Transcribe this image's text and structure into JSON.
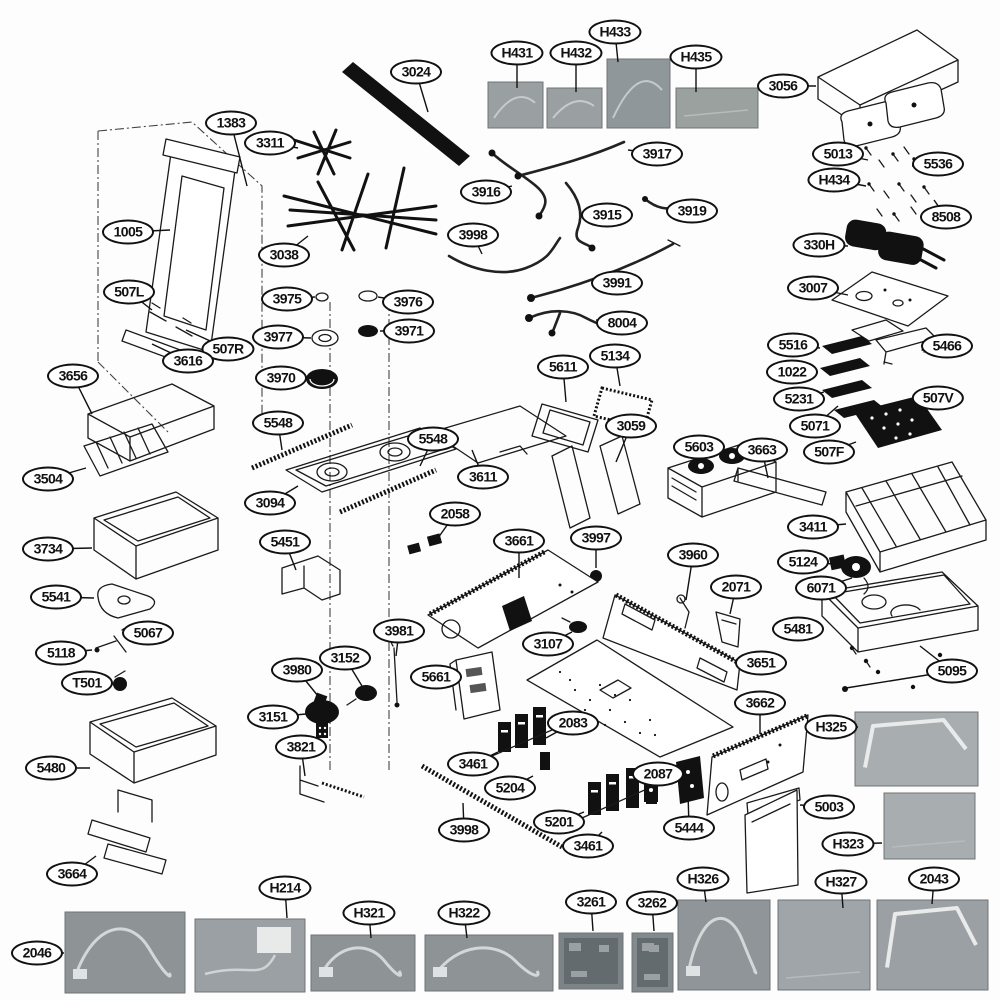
{
  "diagram": {
    "type": "exploded-parts-diagram",
    "background": "#fdfdfd"
  },
  "colors": {
    "line": "#1a1a1a",
    "callout_border": "#111111",
    "photo_gray": "#9aa0a3"
  },
  "callouts": [
    {
      "label": "1383",
      "x": 231,
      "y": 123,
      "to": [
        [
          247,
          186
        ]
      ]
    },
    {
      "label": "3311",
      "x": 270,
      "y": 143,
      "to": [
        [
          298,
          148
        ]
      ]
    },
    {
      "label": "3024",
      "x": 416,
      "y": 72,
      "to": [
        [
          428,
          112
        ]
      ]
    },
    {
      "label": "H431",
      "x": 517,
      "y": 53,
      "to": [
        [
          517,
          88
        ]
      ]
    },
    {
      "label": "H432",
      "x": 576,
      "y": 53,
      "to": [
        [
          576,
          92
        ]
      ]
    },
    {
      "label": "H433",
      "x": 615,
      "y": 32,
      "to": [
        [
          618,
          62
        ]
      ]
    },
    {
      "label": "H435",
      "x": 696,
      "y": 57,
      "to": [
        [
          696,
          92
        ]
      ]
    },
    {
      "label": "3056",
      "x": 783,
      "y": 86,
      "to": [
        [
          816,
          86
        ]
      ]
    },
    {
      "label": "5013",
      "x": 838,
      "y": 154,
      "to": [
        [
          868,
          160
        ]
      ]
    },
    {
      "label": "5536",
      "x": 938,
      "y": 164,
      "to": [
        [
          912,
          166
        ]
      ]
    },
    {
      "label": "H434",
      "x": 834,
      "y": 180,
      "to": [
        [
          866,
          186
        ]
      ]
    },
    {
      "label": "8508",
      "x": 946,
      "y": 217,
      "to": [
        [
          934,
          200
        ]
      ]
    },
    {
      "label": "3919",
      "x": 692,
      "y": 211,
      "to": [
        [
          673,
          208
        ]
      ]
    },
    {
      "label": "3917",
      "x": 657,
      "y": 154,
      "to": [
        [
          628,
          150
        ]
      ]
    },
    {
      "label": "3916",
      "x": 486,
      "y": 192,
      "to": [
        [
          512,
          186
        ]
      ]
    },
    {
      "label": "3915",
      "x": 607,
      "y": 215,
      "to": [
        [
          584,
          220
        ]
      ]
    },
    {
      "label": "3998",
      "x": 473,
      "y": 235,
      "to": [
        [
          482,
          254
        ]
      ]
    },
    {
      "label": "1005",
      "x": 128,
      "y": 232,
      "to": [
        [
          170,
          230
        ]
      ]
    },
    {
      "label": "3038",
      "x": 284,
      "y": 255,
      "to": [
        [
          308,
          236
        ]
      ]
    },
    {
      "label": "330H",
      "x": 819,
      "y": 245,
      "to": [
        [
          848,
          246
        ]
      ]
    },
    {
      "label": "3007",
      "x": 813,
      "y": 288,
      "to": [
        [
          848,
          295
        ]
      ]
    },
    {
      "label": "507L",
      "x": 129,
      "y": 292,
      "to": [
        [
          152,
          310
        ]
      ]
    },
    {
      "label": "3975",
      "x": 287,
      "y": 299,
      "to": [
        [
          315,
          297
        ]
      ]
    },
    {
      "label": "3976",
      "x": 408,
      "y": 302,
      "to": [
        [
          378,
          297
        ]
      ]
    },
    {
      "label": "3971",
      "x": 409,
      "y": 331,
      "to": [
        [
          380,
          331
        ]
      ]
    },
    {
      "label": "3977",
      "x": 278,
      "y": 337,
      "to": [
        [
          311,
          338
        ]
      ]
    },
    {
      "label": "507R",
      "x": 228,
      "y": 349,
      "to": [
        [
          186,
          330
        ]
      ]
    },
    {
      "label": "3616",
      "x": 188,
      "y": 361,
      "to": [
        [
          152,
          344
        ]
      ]
    },
    {
      "label": "3656",
      "x": 73,
      "y": 376,
      "to": [
        [
          92,
          414
        ]
      ]
    },
    {
      "label": "3970",
      "x": 281,
      "y": 378,
      "to": [
        [
          305,
          378
        ]
      ]
    },
    {
      "label": "3991",
      "x": 617,
      "y": 283,
      "to": [
        [
          592,
          286
        ]
      ]
    },
    {
      "label": "8004",
      "x": 622,
      "y": 323,
      "to": [
        [
          596,
          320
        ]
      ]
    },
    {
      "label": "5134",
      "x": 615,
      "y": 356,
      "to": [
        [
          620,
          386
        ]
      ]
    },
    {
      "label": "5611",
      "x": 563,
      "y": 367,
      "to": [
        [
          566,
          402
        ]
      ]
    },
    {
      "label": "5516",
      "x": 793,
      "y": 345,
      "to": [
        [
          820,
          348
        ]
      ]
    },
    {
      "label": "5466",
      "x": 947,
      "y": 346,
      "to": [
        [
          922,
          350
        ]
      ]
    },
    {
      "label": "1022",
      "x": 792,
      "y": 372,
      "to": [
        [
          818,
          372
        ]
      ]
    },
    {
      "label": "5231",
      "x": 799,
      "y": 399,
      "to": [
        [
          824,
          392
        ]
      ]
    },
    {
      "label": "5071",
      "x": 815,
      "y": 426,
      "to": [
        [
          838,
          406
        ]
      ]
    },
    {
      "label": "507V",
      "x": 938,
      "y": 398,
      "to": [
        [
          916,
          420
        ]
      ]
    },
    {
      "label": "507F",
      "x": 829,
      "y": 452,
      "to": [
        [
          856,
          442
        ]
      ]
    },
    {
      "label": "5548",
      "x": 278,
      "y": 423,
      "to": [
        [
          282,
          450
        ]
      ]
    },
    {
      "label": "5548",
      "x": 433,
      "y": 439,
      "to": [
        [
          420,
          466
        ]
      ]
    },
    {
      "label": "3094",
      "x": 270,
      "y": 503,
      "to": [
        [
          298,
          486
        ]
      ]
    },
    {
      "label": "3504",
      "x": 48,
      "y": 479,
      "to": [
        [
          86,
          468
        ]
      ]
    },
    {
      "label": "3611",
      "x": 483,
      "y": 477,
      "to": [
        [
          472,
          450
        ]
      ]
    },
    {
      "label": "3059",
      "x": 631,
      "y": 426,
      "to": [
        [
          616,
          462
        ]
      ]
    },
    {
      "label": "5603",
      "x": 699,
      "y": 447,
      "to": [
        [
          712,
          470
        ]
      ]
    },
    {
      "label": "3663",
      "x": 762,
      "y": 450,
      "to": [
        [
          768,
          478
        ]
      ]
    },
    {
      "label": "3411",
      "x": 813,
      "y": 527,
      "to": [
        [
          846,
          524
        ]
      ]
    },
    {
      "label": "3734",
      "x": 48,
      "y": 549,
      "to": [
        [
          92,
          548
        ]
      ]
    },
    {
      "label": "5451",
      "x": 285,
      "y": 542,
      "to": [
        [
          296,
          570
        ]
      ]
    },
    {
      "label": "2058",
      "x": 455,
      "y": 514,
      "to": [
        [
          438,
          538
        ]
      ]
    },
    {
      "label": "3661",
      "x": 519,
      "y": 541,
      "to": [
        [
          519,
          578
        ]
      ]
    },
    {
      "label": "3997",
      "x": 596,
      "y": 538,
      "to": [
        [
          596,
          568
        ]
      ]
    },
    {
      "label": "3960",
      "x": 693,
      "y": 555,
      "to": [
        [
          686,
          600
        ]
      ]
    },
    {
      "label": "5124",
      "x": 803,
      "y": 562,
      "to": [
        [
          834,
          564
        ]
      ]
    },
    {
      "label": "2071",
      "x": 736,
      "y": 587,
      "to": [
        [
          730,
          614
        ]
      ]
    },
    {
      "label": "6071",
      "x": 821,
      "y": 588,
      "to": [
        [
          852,
          578
        ]
      ]
    },
    {
      "label": "5541",
      "x": 56,
      "y": 597,
      "to": [
        [
          94,
          598
        ]
      ]
    },
    {
      "label": "5481",
      "x": 798,
      "y": 629,
      "to": [
        [
          822,
          628
        ]
      ]
    },
    {
      "label": "5067",
      "x": 148,
      "y": 633,
      "to": [
        [
          130,
          640
        ]
      ]
    },
    {
      "label": "5118",
      "x": 61,
      "y": 653,
      "to": [
        [
          92,
          650
        ]
      ]
    },
    {
      "label": "3981",
      "x": 399,
      "y": 631,
      "to": [
        [
          396,
          656
        ]
      ]
    },
    {
      "label": "3152",
      "x": 345,
      "y": 658,
      "to": [
        [
          362,
          686
        ]
      ]
    },
    {
      "label": "5661",
      "x": 436,
      "y": 677,
      "to": [
        [
          456,
          678
        ]
      ]
    },
    {
      "label": "3107",
      "x": 548,
      "y": 644,
      "to": [
        [
          572,
          632
        ]
      ]
    },
    {
      "label": "3651",
      "x": 761,
      "y": 663,
      "to": [
        [
          740,
          662
        ]
      ]
    },
    {
      "label": "5095",
      "x": 952,
      "y": 671,
      "to": [
        [
          920,
          646
        ],
        [
          846,
          688
        ]
      ]
    },
    {
      "label": "T501",
      "x": 87,
      "y": 683,
      "to": [
        [
          114,
          684
        ]
      ]
    },
    {
      "label": "3980",
      "x": 297,
      "y": 670,
      "to": [
        [
          318,
          696
        ]
      ]
    },
    {
      "label": "3151",
      "x": 273,
      "y": 717,
      "to": [
        [
          306,
          714
        ]
      ]
    },
    {
      "label": "2083",
      "x": 573,
      "y": 723,
      "to": [
        [
          546,
          738
        ]
      ]
    },
    {
      "label": "3662",
      "x": 760,
      "y": 703,
      "to": [
        [
          760,
          734
        ]
      ]
    },
    {
      "label": "H325",
      "x": 831,
      "y": 727,
      "to": [
        [
          858,
          727
        ]
      ]
    },
    {
      "label": "3821",
      "x": 301,
      "y": 747,
      "to": [
        [
          305,
          776
        ]
      ]
    },
    {
      "label": "5480",
      "x": 51,
      "y": 768,
      "to": [
        [
          90,
          768
        ]
      ]
    },
    {
      "label": "3461",
      "x": 473,
      "y": 764,
      "to": [
        [
          498,
          752
        ]
      ]
    },
    {
      "label": "5204",
      "x": 510,
      "y": 788,
      "to": [
        [
          533,
          776
        ]
      ]
    },
    {
      "label": "2087",
      "x": 658,
      "y": 774,
      "to": [
        [
          650,
          788
        ]
      ]
    },
    {
      "label": "5201",
      "x": 559,
      "y": 822,
      "to": [
        [
          584,
          812
        ]
      ]
    },
    {
      "label": "3461",
      "x": 588,
      "y": 846,
      "to": [
        [
          602,
          832
        ]
      ]
    },
    {
      "label": "3998",
      "x": 464,
      "y": 830,
      "to": [
        [
          463,
          803
        ]
      ]
    },
    {
      "label": "5444",
      "x": 689,
      "y": 828,
      "to": [
        [
          688,
          792
        ]
      ]
    },
    {
      "label": "5003",
      "x": 829,
      "y": 807,
      "to": [
        [
          800,
          805
        ]
      ]
    },
    {
      "label": "H323",
      "x": 848,
      "y": 844,
      "to": [
        [
          882,
          843
        ]
      ]
    },
    {
      "label": "3664",
      "x": 72,
      "y": 874,
      "to": [
        [
          96,
          856
        ]
      ]
    },
    {
      "label": "H214",
      "x": 285,
      "y": 888,
      "to": [
        [
          287,
          918
        ]
      ]
    },
    {
      "label": "H326",
      "x": 703,
      "y": 879,
      "to": [
        [
          706,
          902
        ]
      ]
    },
    {
      "label": "H327",
      "x": 841,
      "y": 882,
      "to": [
        [
          843,
          908
        ]
      ]
    },
    {
      "label": "2043",
      "x": 934,
      "y": 879,
      "to": [
        [
          932,
          904
        ]
      ]
    },
    {
      "label": "2046",
      "x": 37,
      "y": 953,
      "to": [
        [
          64,
          953
        ]
      ]
    },
    {
      "label": "H321",
      "x": 369,
      "y": 913,
      "to": [
        [
          371,
          938
        ]
      ]
    },
    {
      "label": "H322",
      "x": 464,
      "y": 913,
      "to": [
        [
          467,
          938
        ]
      ]
    },
    {
      "label": "3261",
      "x": 591,
      "y": 902,
      "to": [
        [
          593,
          931
        ]
      ]
    },
    {
      "label": "3262",
      "x": 652,
      "y": 903,
      "to": [
        [
          654,
          931
        ]
      ]
    }
  ],
  "photos": [
    {
      "name": "photo-H431",
      "x": 488,
      "y": 82,
      "w": 55,
      "h": 46,
      "shade": "#9a9fa2",
      "decor": "curve"
    },
    {
      "name": "photo-H432",
      "x": 547,
      "y": 88,
      "w": 55,
      "h": 40,
      "shade": "#9a9fa2",
      "decor": "curve"
    },
    {
      "name": "photo-H433",
      "x": 607,
      "y": 59,
      "w": 63,
      "h": 69,
      "shade": "#8f979a",
      "decor": "curve"
    },
    {
      "name": "photo-H435",
      "x": 676,
      "y": 88,
      "w": 82,
      "h": 40,
      "shade": "#9ba19e",
      "decor": "plain"
    },
    {
      "name": "photo-H325",
      "x": 855,
      "y": 712,
      "w": 123,
      "h": 74,
      "shade": "#a8adb0",
      "decor": "tube"
    },
    {
      "name": "photo-H323",
      "x": 884,
      "y": 793,
      "w": 91,
      "h": 66,
      "shade": "#a8adb0",
      "decor": "plain"
    },
    {
      "name": "photo-2046",
      "x": 65,
      "y": 912,
      "w": 120,
      "h": 81,
      "shade": "#8e9396",
      "decor": "wire"
    },
    {
      "name": "photo-H214",
      "x": 195,
      "y": 919,
      "w": 110,
      "h": 73,
      "shade": "#9aa0a3",
      "decor": "connector"
    },
    {
      "name": "photo-H321",
      "x": 311,
      "y": 935,
      "w": 104,
      "h": 56,
      "shade": "#8e9396",
      "decor": "wire"
    },
    {
      "name": "photo-H322",
      "x": 425,
      "y": 935,
      "w": 128,
      "h": 56,
      "shade": "#8e9396",
      "decor": "wire"
    },
    {
      "name": "photo-3261",
      "x": 559,
      "y": 933,
      "w": 64,
      "h": 56,
      "shade": "#7d8488",
      "decor": "pcb"
    },
    {
      "name": "photo-3262",
      "x": 632,
      "y": 933,
      "w": 41,
      "h": 59,
      "shade": "#838a8e",
      "decor": "pcb"
    },
    {
      "name": "photo-H326",
      "x": 678,
      "y": 900,
      "w": 92,
      "h": 90,
      "shade": "#8f9598",
      "decor": "wire"
    },
    {
      "name": "photo-H327",
      "x": 778,
      "y": 900,
      "w": 92,
      "h": 90,
      "shade": "#9fa5a8",
      "decor": "plain"
    },
    {
      "name": "photo-2043",
      "x": 877,
      "y": 900,
      "w": 111,
      "h": 90,
      "shade": "#9aa0a3",
      "decor": "tube"
    }
  ]
}
